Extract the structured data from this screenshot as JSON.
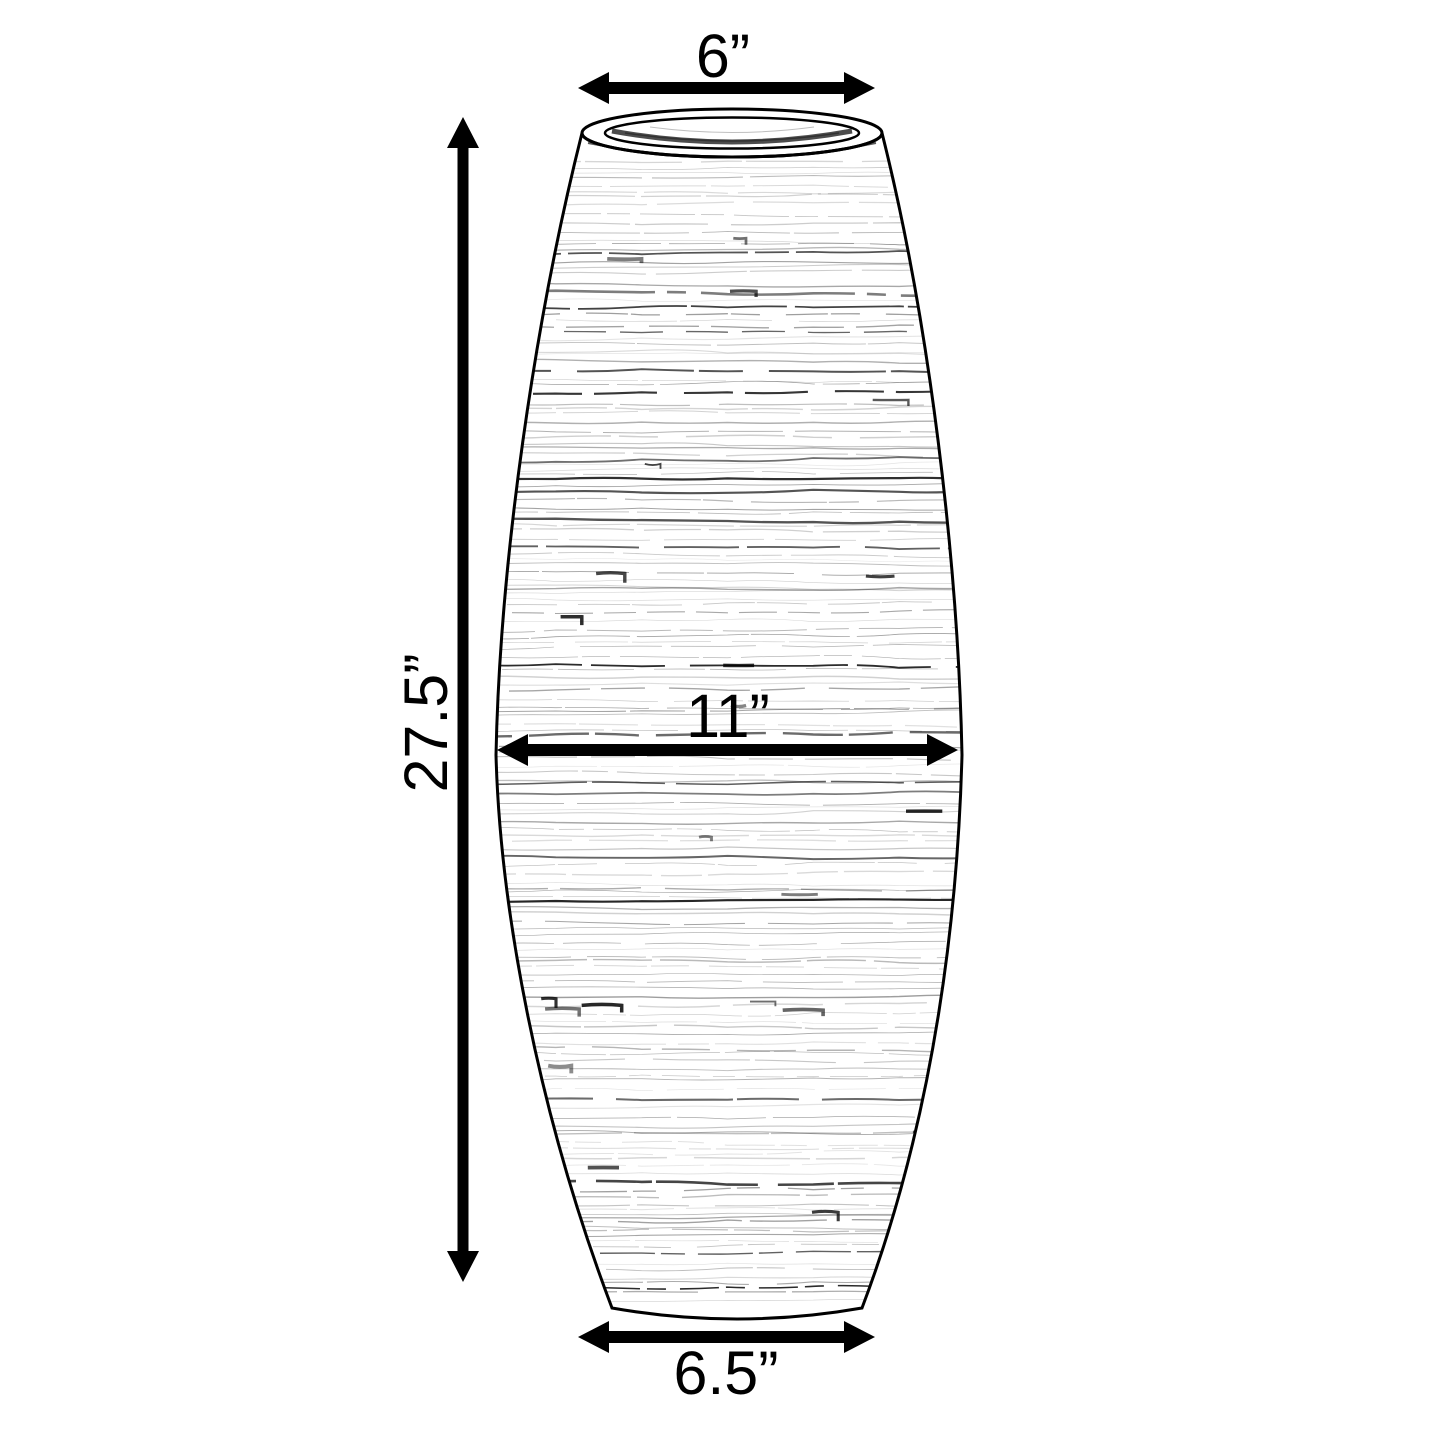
{
  "page": {
    "background": "#ffffff"
  },
  "diagram": {
    "subject": "spun-bamboo tall floor vase line drawing",
    "ink_color": "#000000",
    "labels": {
      "top_width": "6”",
      "height": "27.5”",
      "middle_width": "11”",
      "bottom_width": "6.5”"
    }
  }
}
